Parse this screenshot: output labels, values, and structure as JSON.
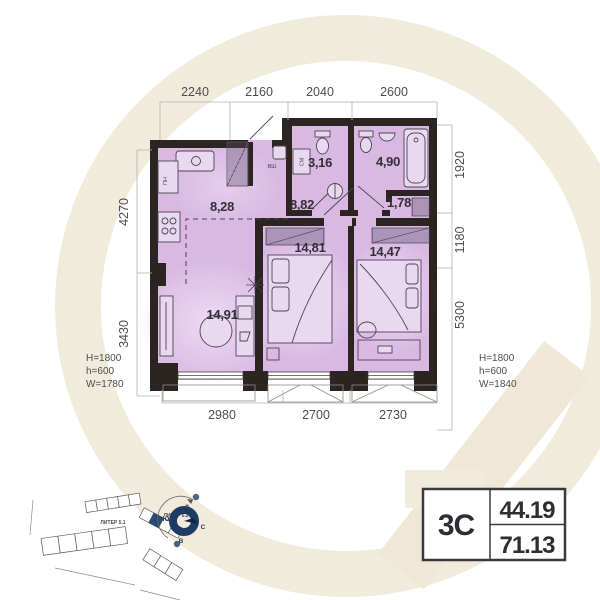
{
  "floor_plan": {
    "dim_top": [
      "2240",
      "2160",
      "2040",
      "2600"
    ],
    "dim_left": [
      "4270",
      "3430"
    ],
    "dim_right": [
      "1920",
      "1180",
      "5300"
    ],
    "dim_bottom": [
      "2980",
      "2700",
      "2730"
    ],
    "areas": {
      "kitchen": "8,28",
      "hallway": "8,82",
      "bathroom_small": "3,16",
      "bathroom_large": "4,90",
      "wardrobe_niche": "1,78",
      "bedroom_center": "14,81",
      "bedroom_right": "14,47",
      "living_room": "14,91"
    },
    "fixture_labels": {
      "washing_machine": "СМ",
      "fridge": "ПН",
      "heater": "ВШ"
    },
    "window_left_annotation": [
      "H=1800",
      "h=600",
      "W=1780"
    ],
    "window_right_annotation": [
      "H=1800",
      "h=600",
      "W=1840"
    ]
  },
  "unit_card": {
    "type": "3С",
    "living_area": "44.19",
    "total_area": "71.13"
  },
  "site_plan": {
    "building_left": "ЛИТЕР 5.1",
    "building_right": "ЛИТЕР 5.2"
  },
  "compass": {
    "north": "С",
    "south": "Ю",
    "west": "З",
    "east": "В"
  },
  "colors": {
    "wall": "#2b2421",
    "room_fill": "#d9b9e2",
    "watermark": "#f1ebdc",
    "accent_blue": "#1e3c63"
  }
}
